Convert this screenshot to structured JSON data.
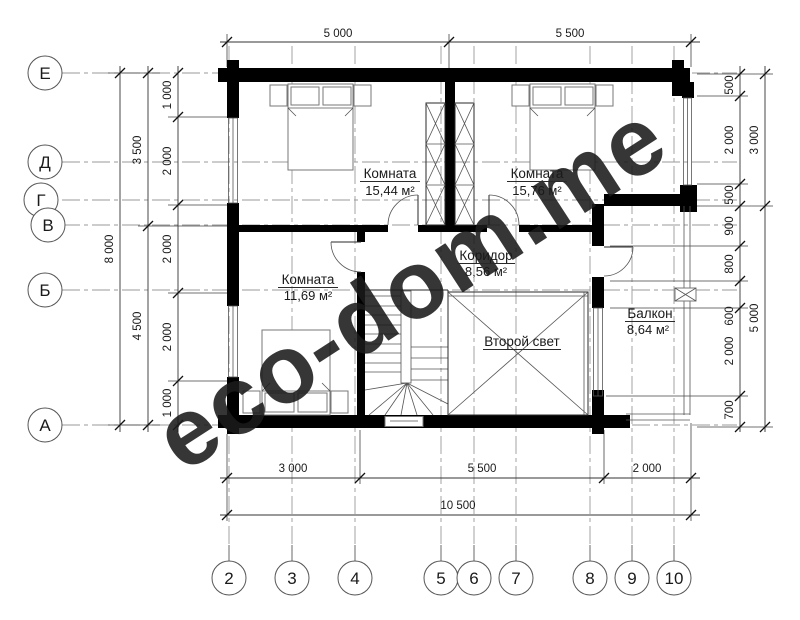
{
  "watermark": {
    "text": "eco-dom.me",
    "color": "#e2e2c0"
  },
  "rooms": [
    {
      "name": "Комната",
      "area": "15,44 м²"
    },
    {
      "name": "Комната",
      "area": "15,76 м²"
    },
    {
      "name": "Комната",
      "area": "11,69 м²"
    },
    {
      "name": "Коридор",
      "area": "8,56 м²"
    },
    {
      "name": "Балкон",
      "area": "8,64 м²"
    },
    {
      "name": "Второй свет",
      "area": ""
    }
  ],
  "axes": {
    "rows": [
      "Е",
      "Д",
      "Г",
      "В",
      "Б",
      "А"
    ],
    "cols": [
      "2",
      "3",
      "4",
      "5",
      "6",
      "7",
      "8",
      "9",
      "10"
    ]
  },
  "dims": {
    "top": [
      "5 000",
      "5 500"
    ],
    "bottom": [
      "3 000",
      "5 500",
      "2 000"
    ],
    "bottom_total": "10 500",
    "left_inner": [
      "1 000",
      "2 000",
      "2 000",
      "2 000",
      "1 000"
    ],
    "left_mid": [
      "3 500",
      "4 500"
    ],
    "left_total": "8 000",
    "right_inner": [
      "500",
      "2 000",
      "500",
      "900",
      "800",
      "600",
      "2 000",
      "700"
    ],
    "right_outer": [
      "3 000",
      "5 000"
    ]
  }
}
